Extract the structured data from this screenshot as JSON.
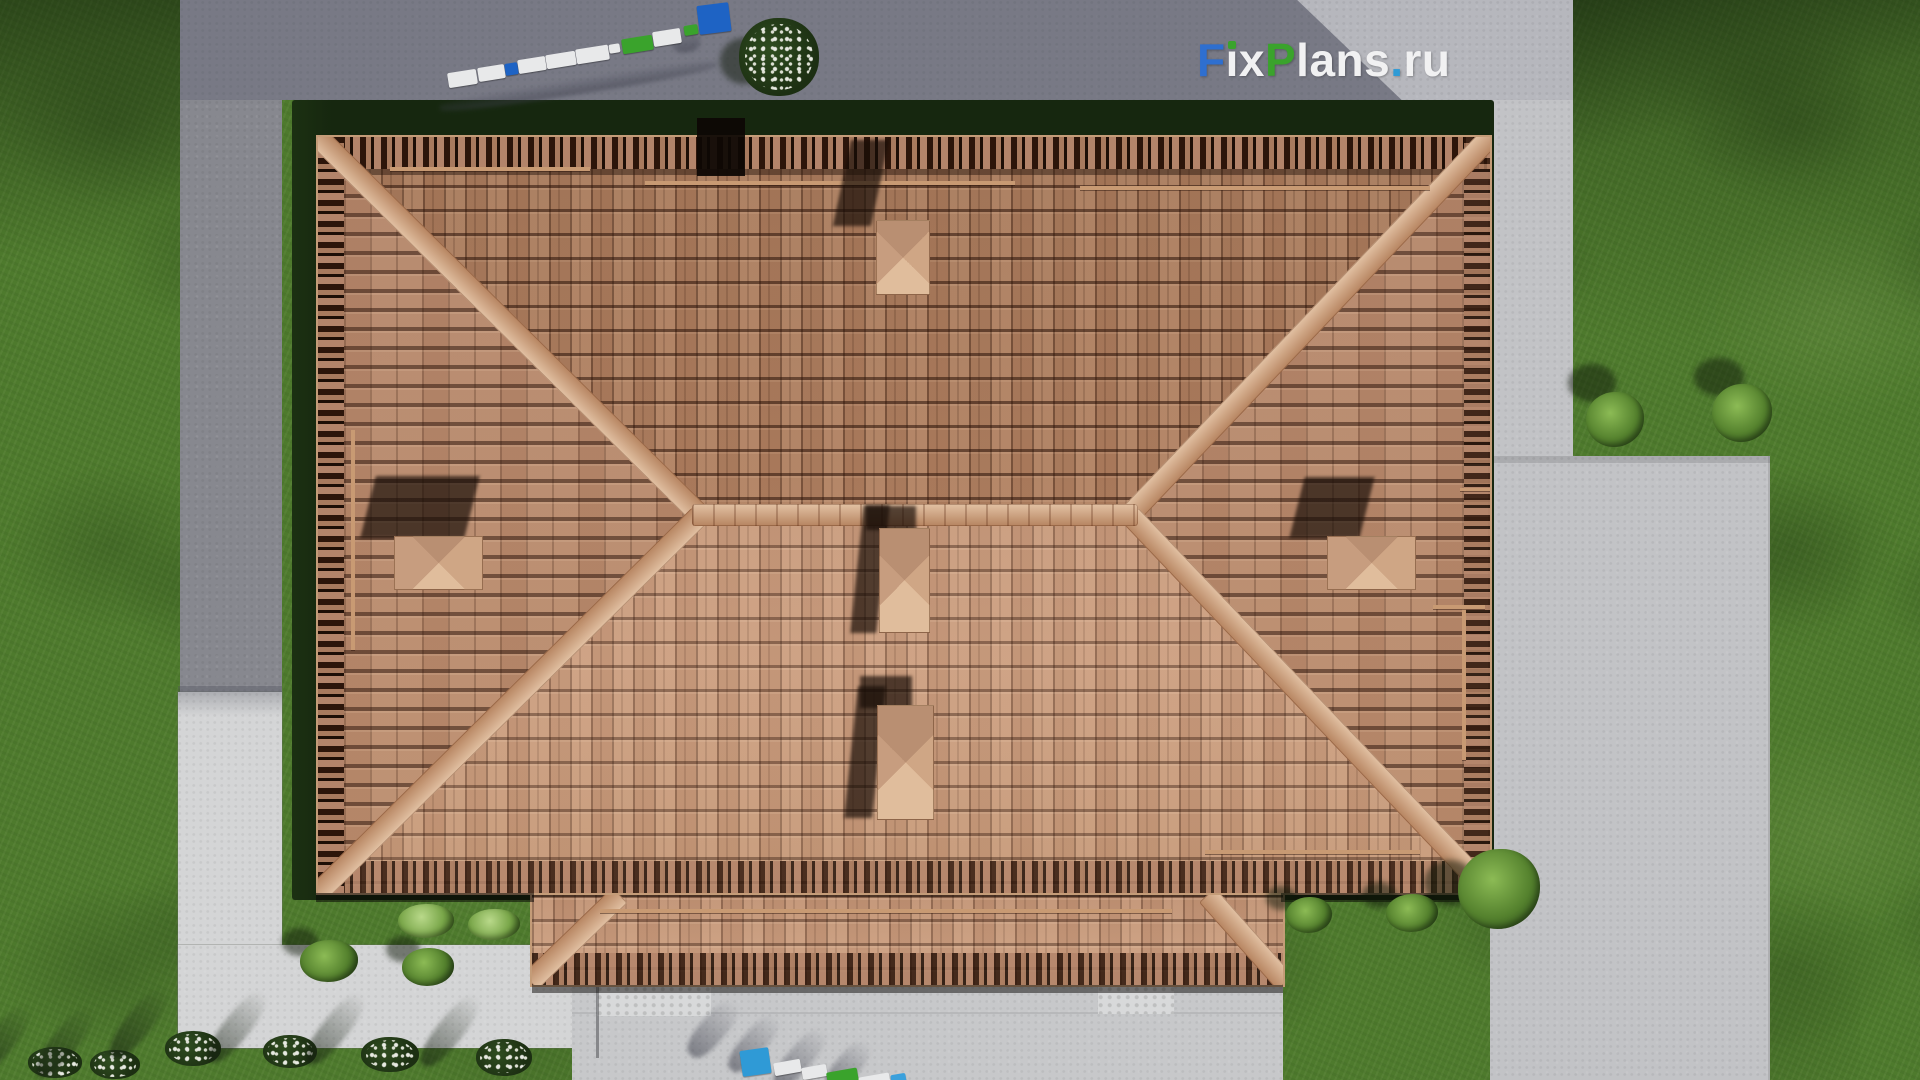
{
  "watermark": {
    "full_text": "FixPlans.ru",
    "parts": {
      "f": "F",
      "ix": "ix",
      "p": "P",
      "lans": "lans",
      "dot": ".",
      "ru": "ru"
    },
    "colors": {
      "f": "#2e6fd0",
      "ix": "#f1f1f2",
      "i_dot": "#3aa32c",
      "p": "#3aa32c",
      "lans": "#f1f1f2",
      "dot": "#2e9bd6",
      "ru": "#f1f1f2"
    }
  },
  "scene": {
    "view": "top-down aerial 3d render of hip-roof house",
    "palette": {
      "roof_tile_north": "#ab7c5e",
      "roof_tile_south": "#c59878",
      "roof_ridge_hip": "#cb9c76",
      "grass": "#4e7a2d",
      "hedge_shadow_band": "#16270f",
      "driveway_shadowed": "#87888f",
      "driveway_lit": "#b6b7bd",
      "garden_path_bright": "#d4d5d6",
      "patio": "#c2c3c6",
      "porch_slab": "#c7c8ca",
      "bench_blue": "#1e63c4",
      "bench_green": "#3aa32c",
      "bench_white": "#e8e9ea"
    },
    "elements": {
      "chimney_count": 5,
      "roof_sections": [
        "main-hip-roof",
        "porch-roof"
      ],
      "ground_areas": [
        "grass",
        "driveway",
        "garden-path",
        "patio",
        "porch-slab"
      ],
      "plants": [
        "flowering-shrub",
        "round-bushes",
        "flower-bushes-row"
      ]
    }
  }
}
